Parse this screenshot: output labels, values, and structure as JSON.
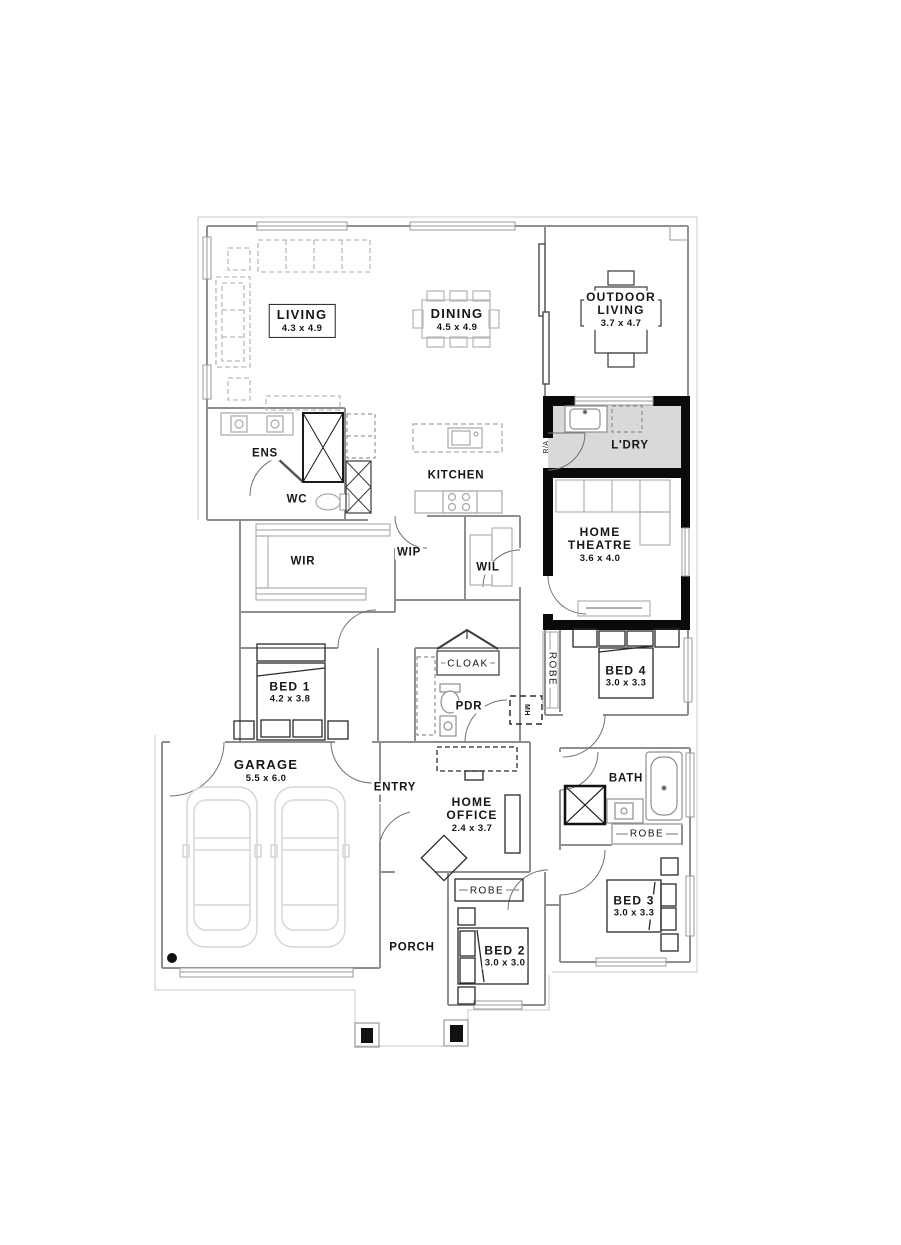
{
  "plan": {
    "type": "single-storey house floor plan",
    "colors": {
      "background": "#ffffff",
      "wall_light": "#8f8f8f",
      "wall_dark": "#0a0a0a",
      "laundry_fill": "#d9d9d9",
      "furniture_light": "#b9b9b9",
      "car_outline": "#d6d6d6",
      "eave_line": "#c9c9c9",
      "text": "#161616"
    },
    "rooms": {
      "living": {
        "label": "LIVING",
        "dims": "4.3 x 4.9"
      },
      "dining": {
        "label": "DINING",
        "dims": "4.5 x 4.9"
      },
      "outdoor": {
        "line1": "OUTDOOR",
        "line2": "LIVING",
        "dims": "3.7 x 4.7"
      },
      "laundry": {
        "label": "L'DRY"
      },
      "ens": {
        "label": "ENS"
      },
      "wc": {
        "label": "WC"
      },
      "kitchen": {
        "label": "KITCHEN"
      },
      "theatre": {
        "line1": "HOME",
        "line2": "THEATRE",
        "dims": "3.6 x 4.0"
      },
      "wir": {
        "label": "WIR"
      },
      "wip": {
        "label": "WIP"
      },
      "wil": {
        "label": "WIL"
      },
      "bed1": {
        "label": "BED 1",
        "dims": "4.2 x 3.8"
      },
      "cloak": {
        "label": "CLOAK"
      },
      "pdr": {
        "label": "PDR"
      },
      "bed4": {
        "label": "BED 4",
        "dims": "3.0 x 3.3"
      },
      "robe_bed4": {
        "label": "ROBE"
      },
      "garage": {
        "label": "GARAGE",
        "dims": "5.5 x 6.0"
      },
      "entry": {
        "label": "ENTRY"
      },
      "office": {
        "line1": "HOME",
        "line2": "OFFICE",
        "dims": "2.4 x 3.7"
      },
      "bath": {
        "label": "BATH"
      },
      "robe_bath": {
        "label": "ROBE"
      },
      "bed3": {
        "label": "BED 3",
        "dims": "3.0 x 3.3"
      },
      "robe_bed2": {
        "label": "ROBE"
      },
      "bed2": {
        "label": "BED 2",
        "dims": "3.0 x 3.0"
      },
      "porch": {
        "label": "PORCH"
      }
    },
    "annotations": {
      "return_air": "R/A",
      "manhole": "MH"
    }
  }
}
